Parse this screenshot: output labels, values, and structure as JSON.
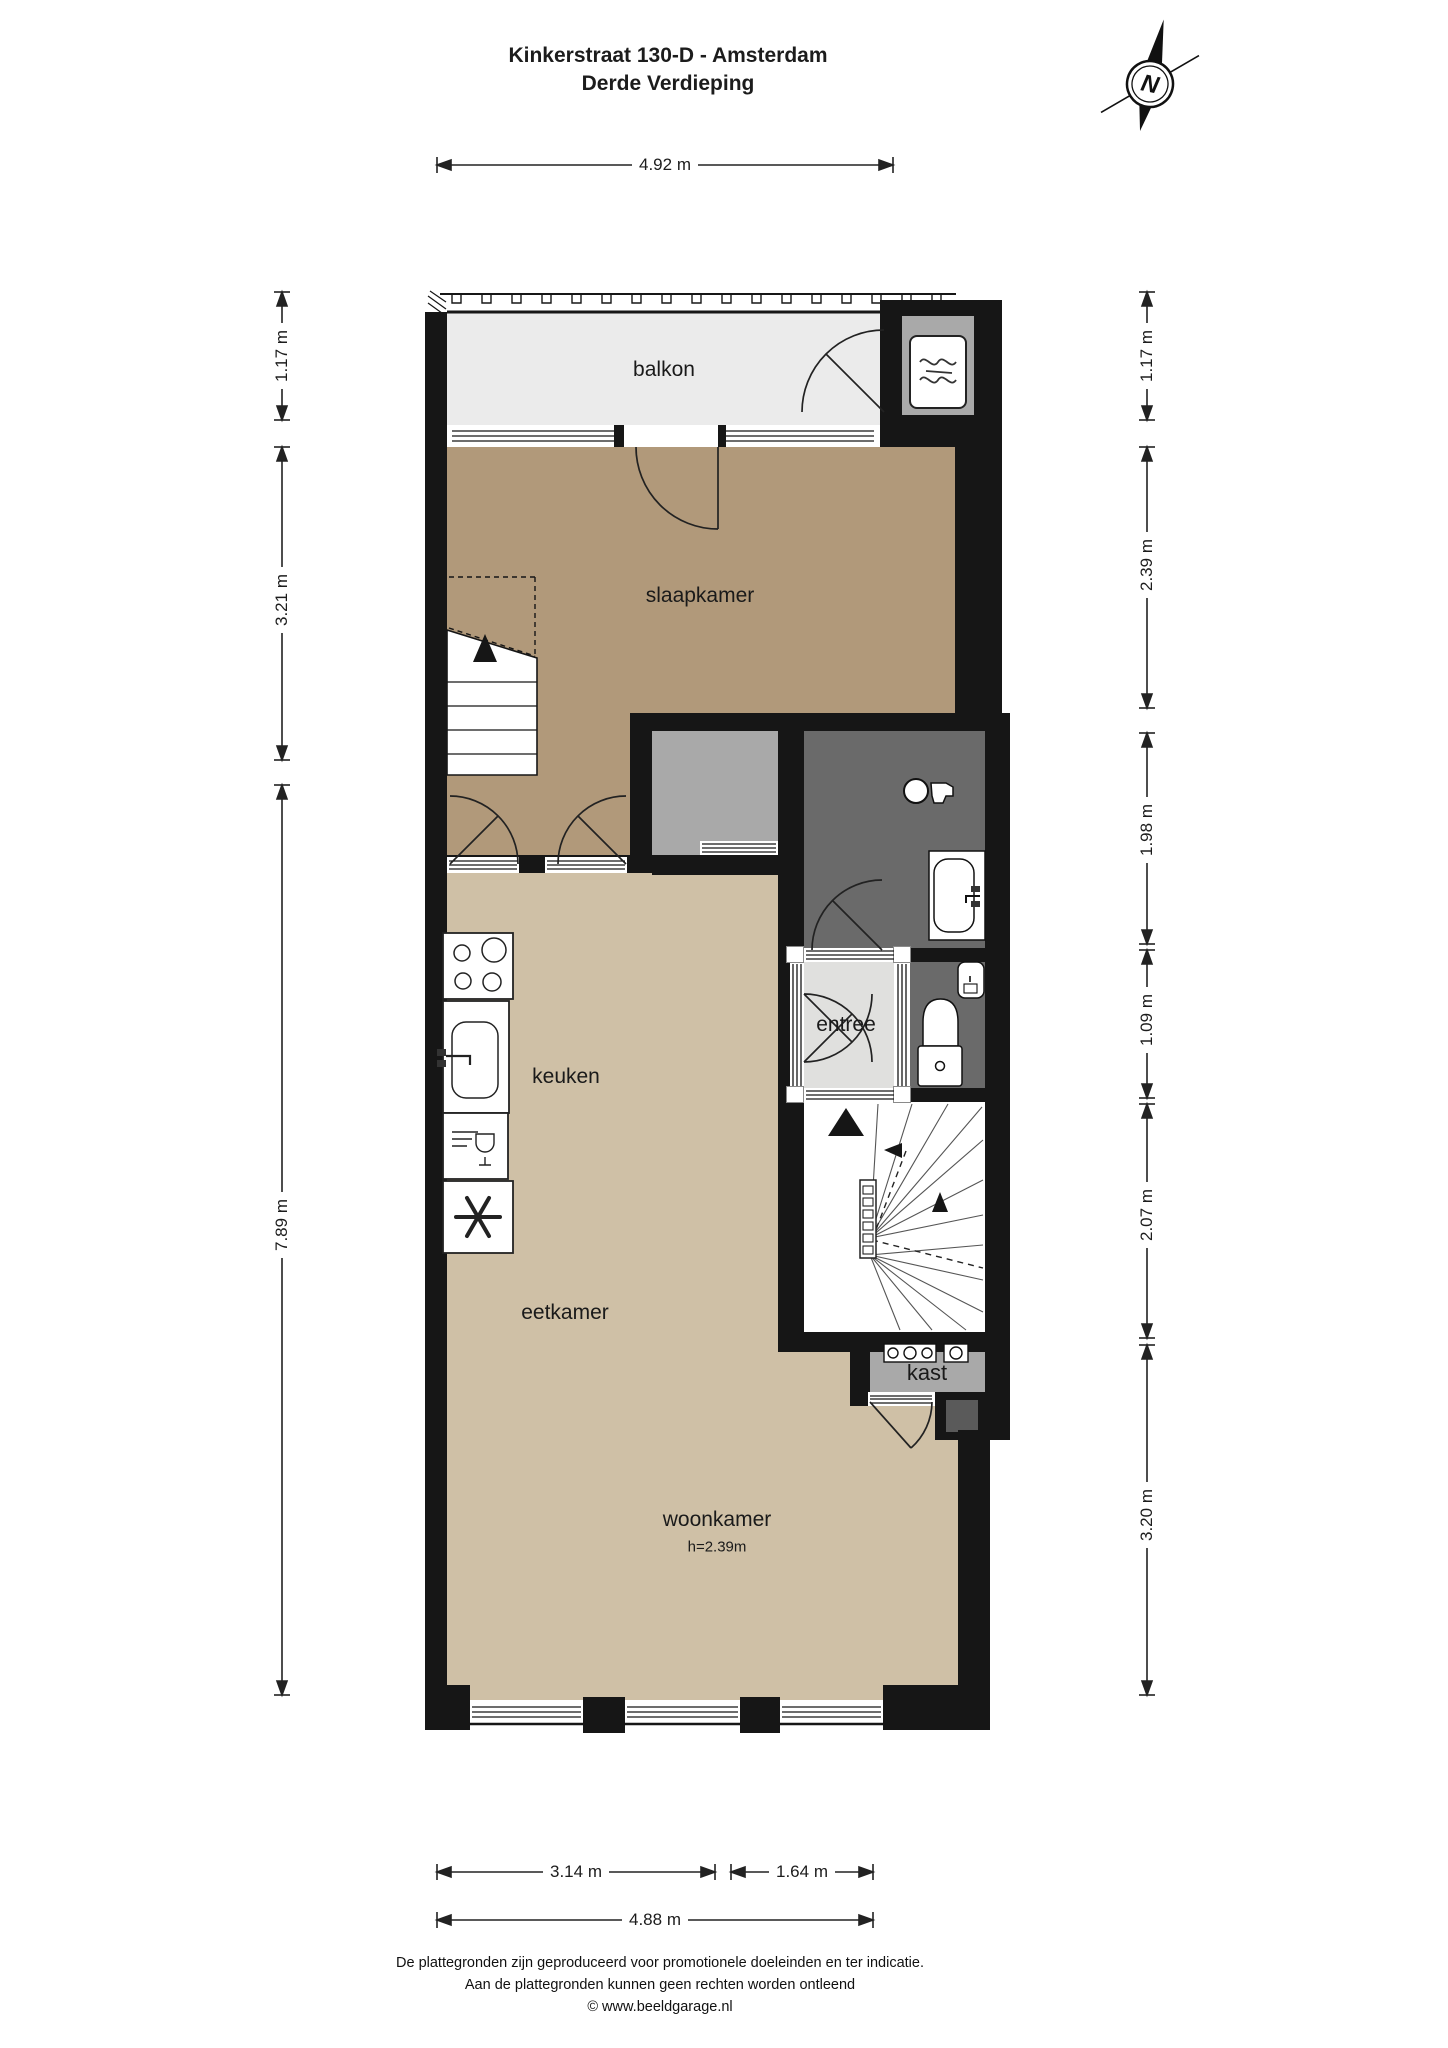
{
  "title": {
    "line1": "Kinkerstraat 130-D - Amsterdam",
    "line2": "Derde Verdieping"
  },
  "compass": {
    "label": "N"
  },
  "rooms": {
    "balkon": "balkon",
    "slaapkamer": "slaapkamer",
    "keuken": "keuken",
    "entree": "entree",
    "eetkamer": "eetkamer",
    "woonkamer": "woonkamer",
    "woonkamer_height": "h=2.39m",
    "kast": "kast"
  },
  "dimensions": {
    "top": "4.92 m",
    "left": [
      "1.17 m",
      "3.21 m",
      "7.89 m"
    ],
    "right": [
      "1.17 m",
      "2.39 m",
      "1.98 m",
      "1.09 m",
      "2.07 m",
      "3.20 m"
    ],
    "bottom_segments": [
      "3.14 m",
      "1.64 m"
    ],
    "bottom_total": "4.88 m"
  },
  "footer": {
    "line1": "De plattegronden zijn geproduceerd voor promotionele doeleinden en ter indicatie.",
    "line2": "Aan de plattegronden kunnen geen rechten worden ontleend",
    "line3": "© www.beeldgarage.nl"
  },
  "colors": {
    "wall": "#161616",
    "bedroom_floor": "#b1997a",
    "living_floor": "#cfc0a6",
    "balcony_floor": "#ebebeb",
    "hall_floor": "#e0e0de",
    "wet_room_floor": "#6a6a6a",
    "closet_floor": "#a9a9a9"
  },
  "icons": {
    "compass": "north-compass-icon",
    "heater": "heater-icon",
    "washer_tap": "washer-tap-icon",
    "sink": "sink-icon",
    "toilet": "toilet-icon",
    "cooktop": "cooktop-icon",
    "dishwasher": "dishwasher-icon",
    "freezer": "freezer-star-icon",
    "meters": "utility-meter-icon",
    "stairs_up": "stairs-up-arrow-icon"
  }
}
